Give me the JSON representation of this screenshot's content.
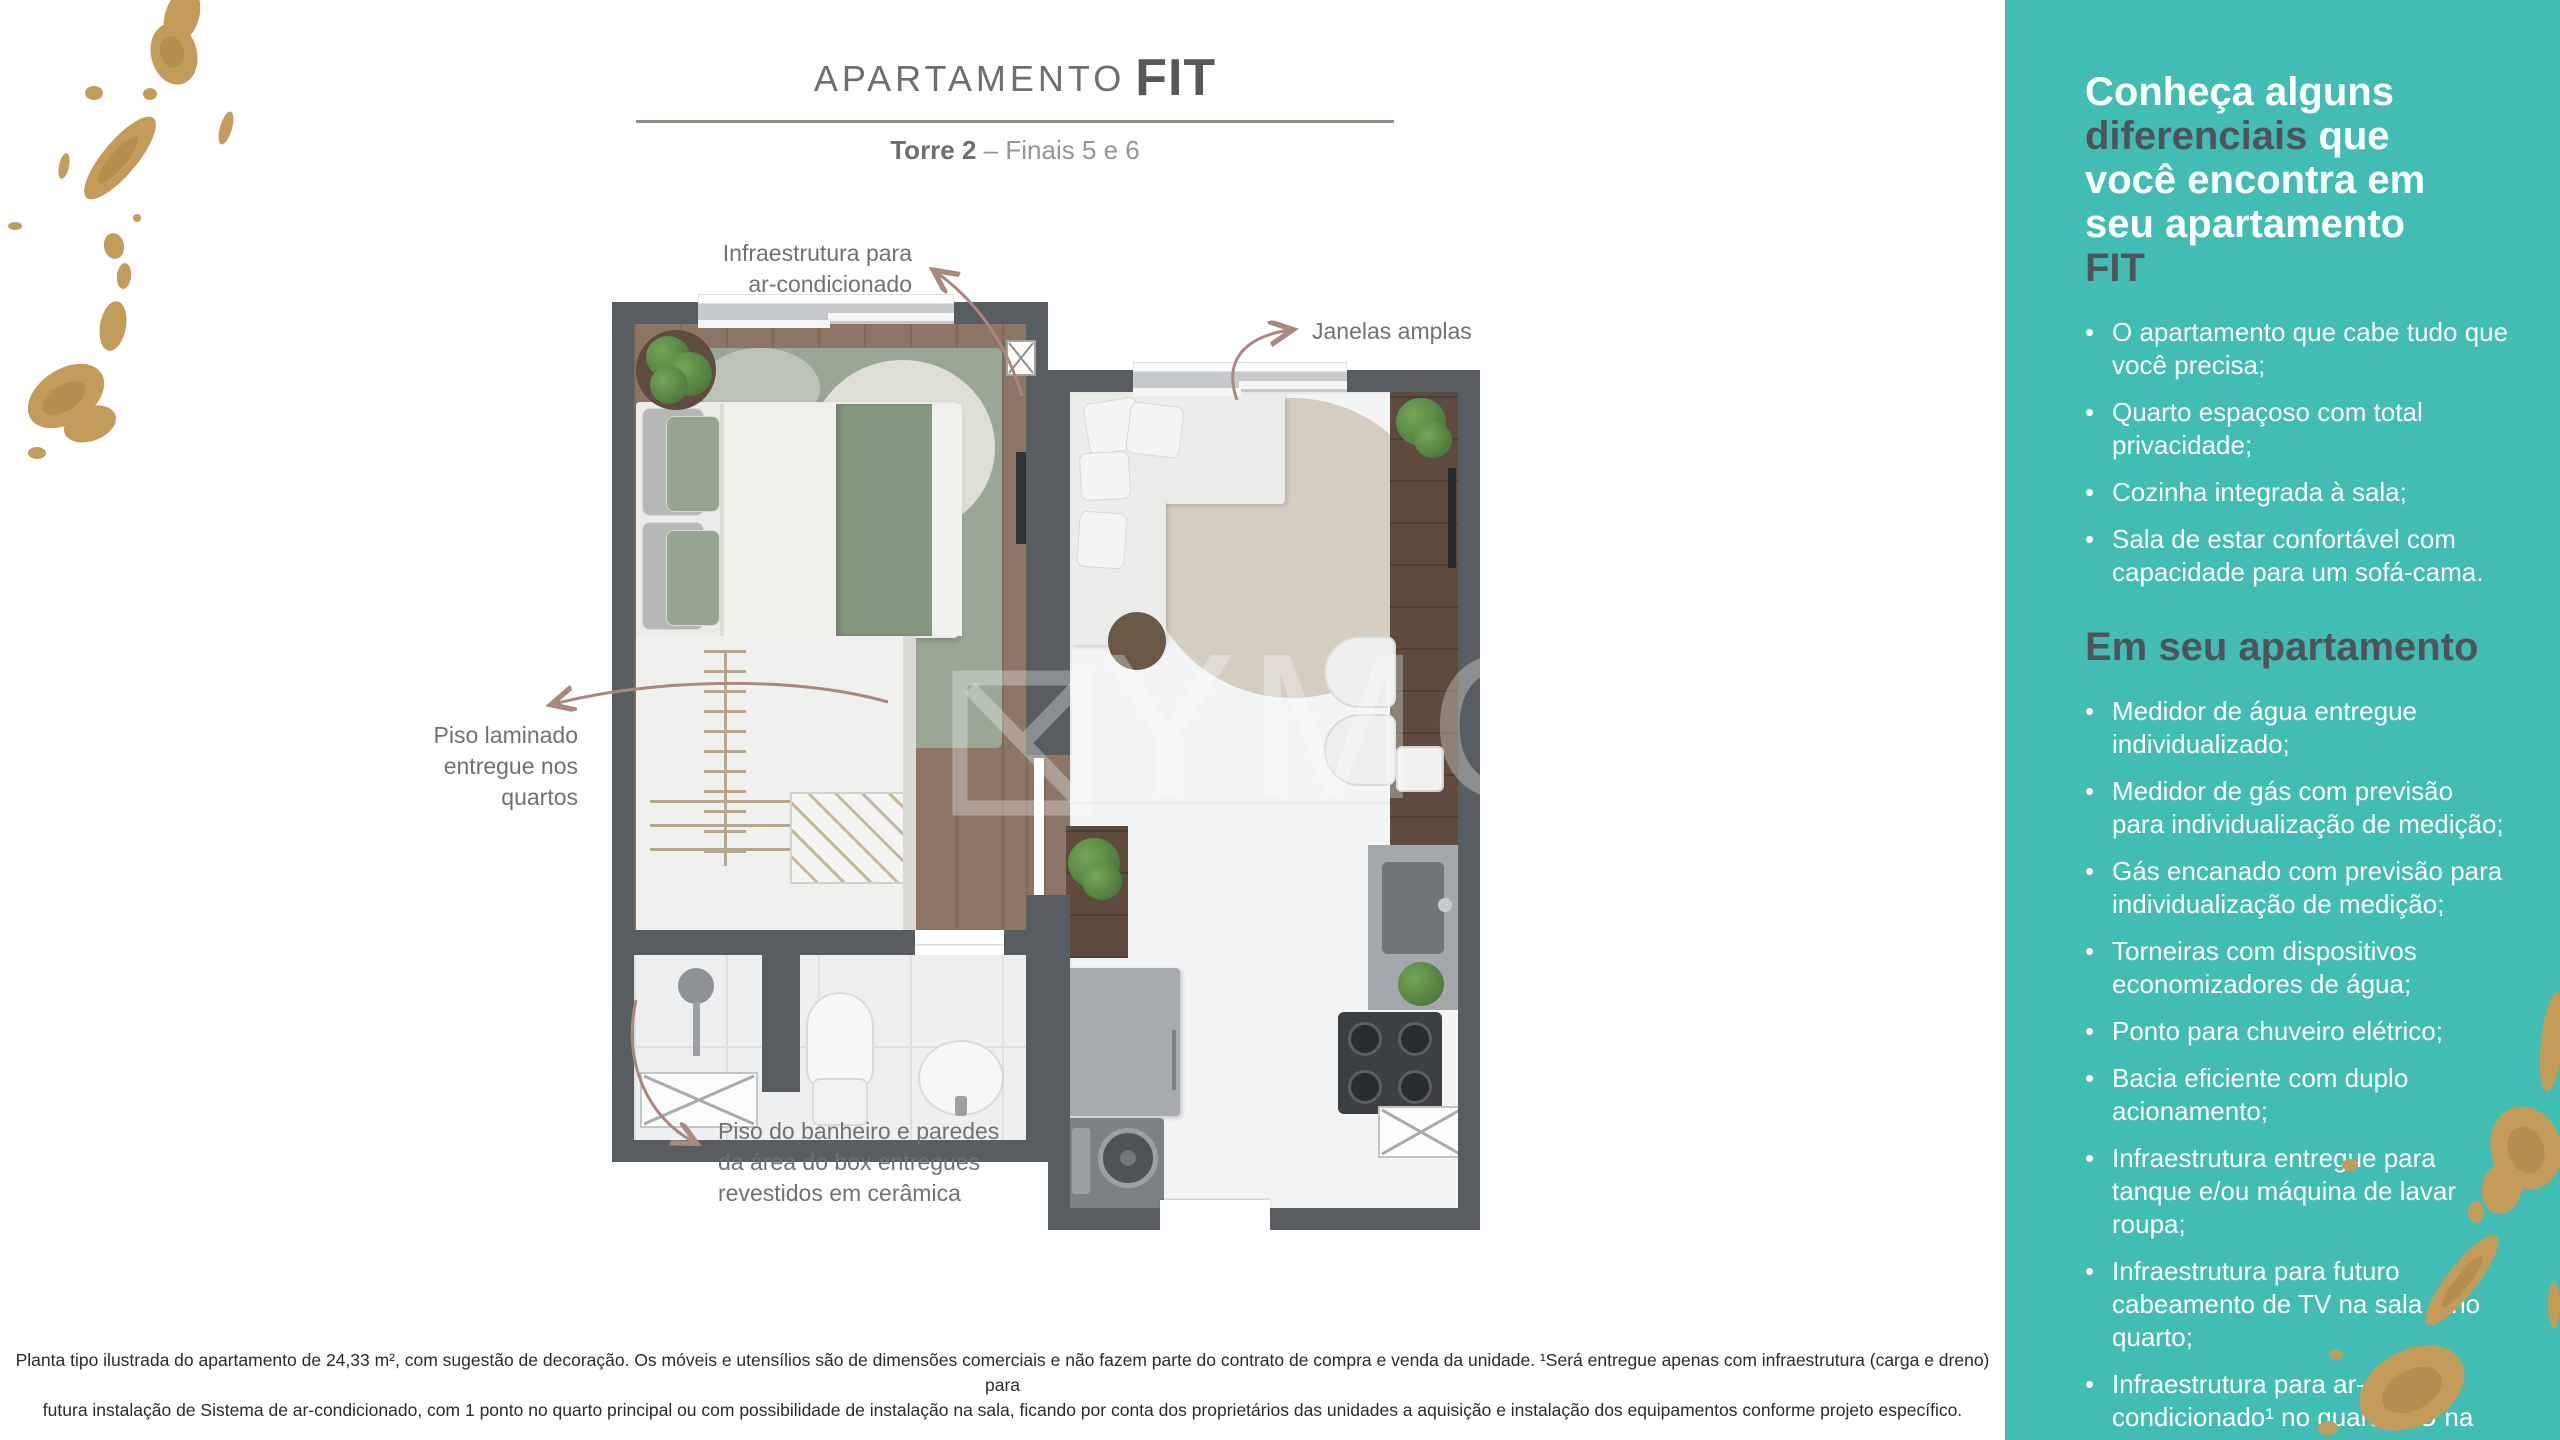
{
  "header": {
    "title_prefix": "APARTAMENTO",
    "title_emphasis": "FIT",
    "subtitle_bold": "Torre 2",
    "subtitle_rest": " – Finais 5 e 6"
  },
  "annotations": {
    "ac_line1": "Infraestrutura para",
    "ac_line2": "ar-condicionado",
    "windows_label": "Janelas amplas",
    "floor_line1": "Piso laminado",
    "floor_line2": "entregue nos",
    "floor_line3": "quartos",
    "bath_line1": "Piso do banheiro e paredes",
    "bath_line2": "da área do box entregues",
    "bath_line3": "revestidos em cerâmica"
  },
  "watermark": {
    "text": "YMOV"
  },
  "sidebar": {
    "heading": {
      "l1": "Conheça alguns",
      "l2_dark": "diferenciais",
      "l2_rest": " que",
      "l3": "você encontra em",
      "l4": "seu apartamento",
      "l5_dark": "FIT"
    },
    "list1": [
      "O apartamento que cabe tudo que você precisa;",
      "Quarto espaçoso com total privacidade;",
      "Cozinha integrada à sala;",
      "Sala de estar confortável com capacidade para um sofá-cama."
    ],
    "section2_heading": "Em seu apartamento",
    "list2": [
      "Medidor de água entregue individualizado;",
      "Medidor de gás com previsão para individualização de medição;",
      "Gás encanado com previsão para individualização de medição;",
      "Torneiras com dispositivos economizadores de água;",
      "Ponto para chuveiro elétrico;",
      "Bacia eficiente com duplo acionamento;",
      "Infraestrutura entregue para tanque e/ou máquina de lavar roupa;",
      "Infraestrutura para futuro cabeamento de TV na sala e no quarto;",
      "Infraestrutura para ar-condicionado¹ no quarto OU na sala."
    ]
  },
  "footer": {
    "line1": "Planta tipo ilustrada do apartamento de 24,33 m², com sugestão de decoração. Os móveis e utensílios são de dimensões comerciais e não fazem parte do contrato de compra e venda da unidade. ¹Será entregue apenas com infraestrutura (carga e dreno) para",
    "line2": "futura instalação de Sistema de ar-condicionado, com 1 ponto no quarto principal ou com possibilidade de instalação na sala, ficando por conta dos proprietários das unidades a aquisição e instalação dos equipamentos conforme projeto específico."
  },
  "colors": {
    "sidebar_teal": "#41bdb3",
    "heading_dark": "#50545a",
    "title_gray": "#6d6e71",
    "rule_mauve": "#9c8b85",
    "arrow_mauve": "#a8887f",
    "wall_gray": "#585d61",
    "gold_foil": "#c49c5a"
  }
}
